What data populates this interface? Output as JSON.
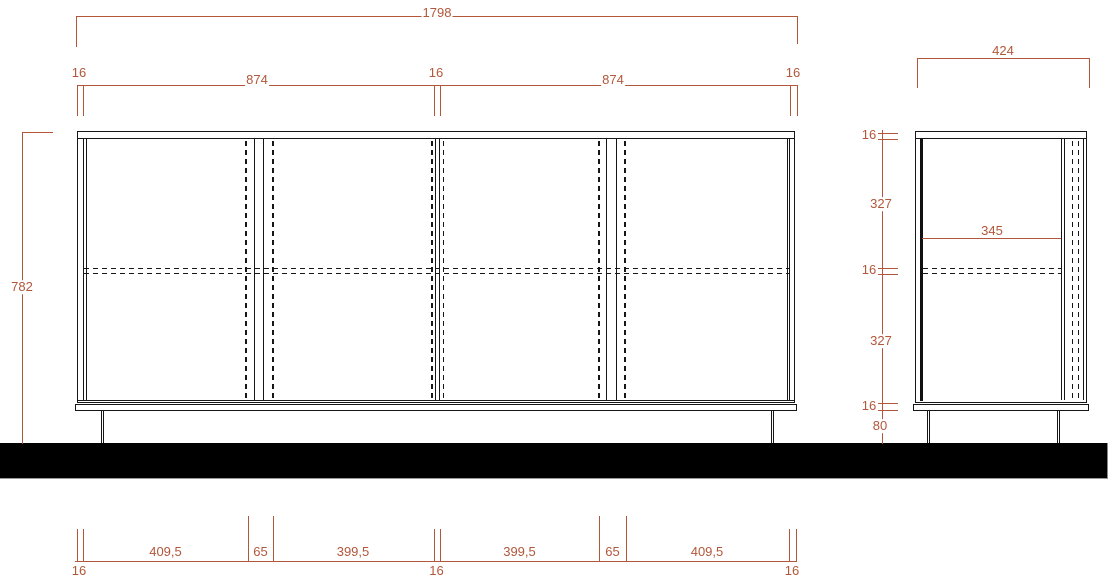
{
  "drawing": {
    "title": "cabinet-orthographic-dimension-drawing",
    "colors": {
      "dimension_lines": "#b2573a",
      "object_lines": "#161616",
      "floor": "#000000"
    },
    "front_view": {
      "overall_width": "1798",
      "overall_height": "782",
      "top_segments": [
        "16",
        "874",
        "16",
        "874",
        "16"
      ],
      "bottom_segments_upper": [
        "409,5",
        "65",
        "399,5",
        "399,5",
        "65",
        "409,5"
      ],
      "bottom_segments_lower": [
        "16",
        "16",
        "16"
      ]
    },
    "side_view": {
      "depth": "424",
      "interior_depth": "345",
      "left_segments": [
        "16",
        "327",
        "16",
        "327",
        "16",
        "80"
      ]
    }
  }
}
